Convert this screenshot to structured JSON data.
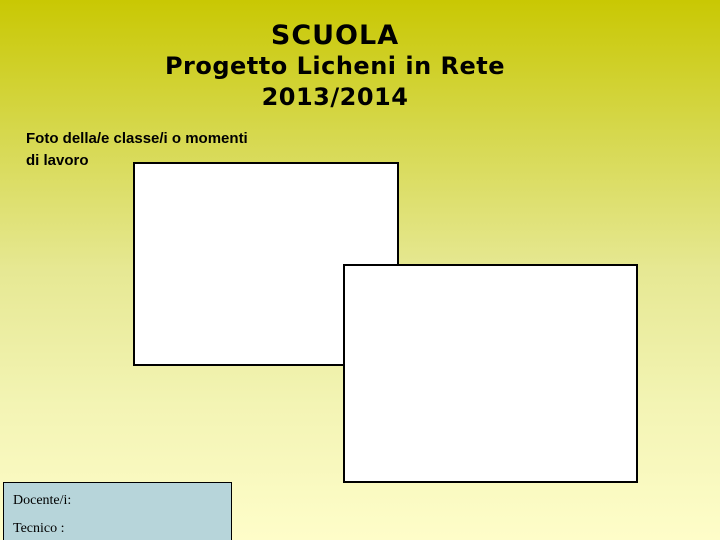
{
  "slide": {
    "title": "SCUOLA",
    "subtitle_lines": [
      "Progetto Licheni in Rete",
      "2013/2014"
    ],
    "caption_lines": [
      "Foto della/e classe/i o momenti",
      "di lavoro"
    ],
    "photo_placeholders": [
      {
        "name": "photo-placeholder-1",
        "content": ""
      },
      {
        "name": "photo-placeholder-2",
        "content": ""
      }
    ],
    "info_box": {
      "lines": [
        "Docente/i:",
        "Tecnico :"
      ]
    },
    "colors": {
      "gradient_top": "#c9c803",
      "gradient_bottom": "#fefdc9",
      "info_box_bg": "#b7d5da",
      "placeholder_bg": "#ffffff",
      "border": "#000000",
      "text": "#000000"
    }
  }
}
